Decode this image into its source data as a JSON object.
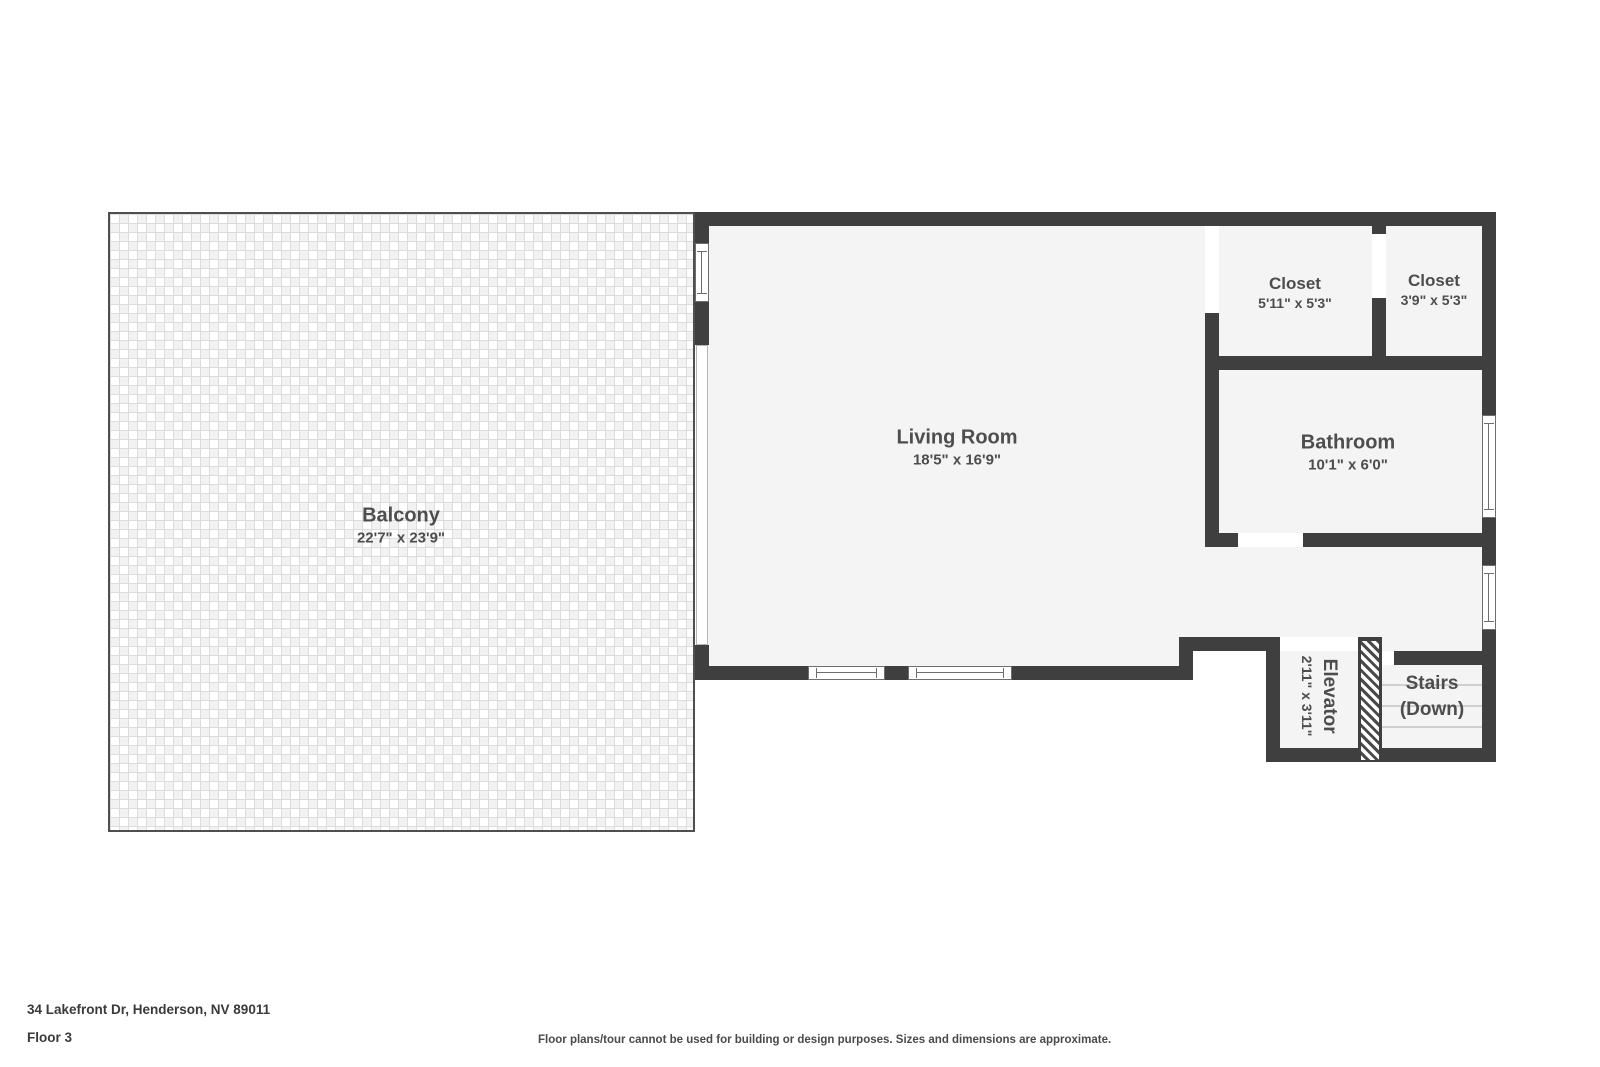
{
  "colors": {
    "wall": "#3f3f3f",
    "floor": "#f4f4f4",
    "label": "#4d4d4d",
    "balcony_border": "#4f4f4f"
  },
  "rooms": [
    {
      "name": "Balcony",
      "dimensions": "22'7\" x 23'9\""
    },
    {
      "name": "Living Room",
      "dimensions": "18'5\" x 16'9\""
    },
    {
      "name": "Closet",
      "dimensions": "5'11\" x 5'3\""
    },
    {
      "name": "Closet",
      "dimensions": "3'9\" x 5'3\""
    },
    {
      "name": "Bathroom",
      "dimensions": "10'1\" x 6'0\""
    },
    {
      "name": "Elevator",
      "dimensions": "2'11\" x 3'11\""
    },
    {
      "name": "Stairs",
      "line2": "(Down)"
    }
  ],
  "footer": {
    "address": "34 Lakefront Dr, Henderson, NV 89011",
    "floor": "Floor 3",
    "disclaimer": "Floor plans/tour cannot be used for building or design purposes. Sizes and dimensions are approximate."
  }
}
